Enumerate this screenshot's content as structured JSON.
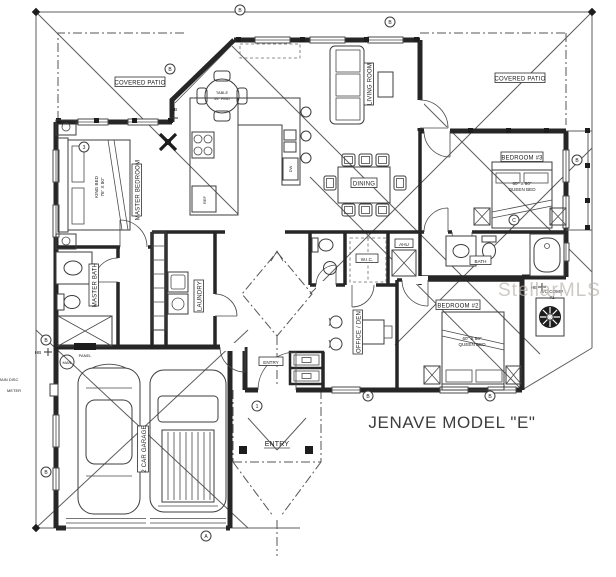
{
  "title": "JENAVE MODEL \"E\"",
  "watermark": "StellarMLS",
  "labels": {
    "covered_patio": "COVERED PATIO",
    "master_bedroom": "MASTER BEDROOM",
    "king_bed_l1": "KING BED",
    "king_bed_l2": "76\" X 80\"",
    "table_l1": "TABLE",
    "table_l2": "54\" RND",
    "living_room": "LIVING ROOM",
    "dining": "DINING",
    "bedroom3": "BEDROOM #3",
    "bedroom2": "BEDROOM #2",
    "queen_l1": "60\" X 80\"",
    "queen_l2": "QUEEN BED",
    "bath": "BATH",
    "master_bath": "MASTER BATH",
    "laundry": "LAUNDRY",
    "wic": "W.I.C.",
    "ahu": "AHU",
    "office_den": "OFFICE / DEN",
    "garage": "2 CAR GARAGE",
    "entry": "ENTRY",
    "ac_l1": "A/C COMP.",
    "ac_l2": "#1",
    "hb": "HB",
    "main_disc": "MAIN DISC",
    "meter": "METER",
    "man": "MAN",
    "panel": "PANEL",
    "ref": "REF",
    "dw": "DW"
  },
  "markers": {
    "b": "B",
    "a": "A",
    "c": "C",
    "n1": "1",
    "n3": "3"
  },
  "colors": {
    "ink": "#262626",
    "thin": "#5d5d5d",
    "watermark": "#b9b4ae",
    "title": "#3c3c3c"
  }
}
